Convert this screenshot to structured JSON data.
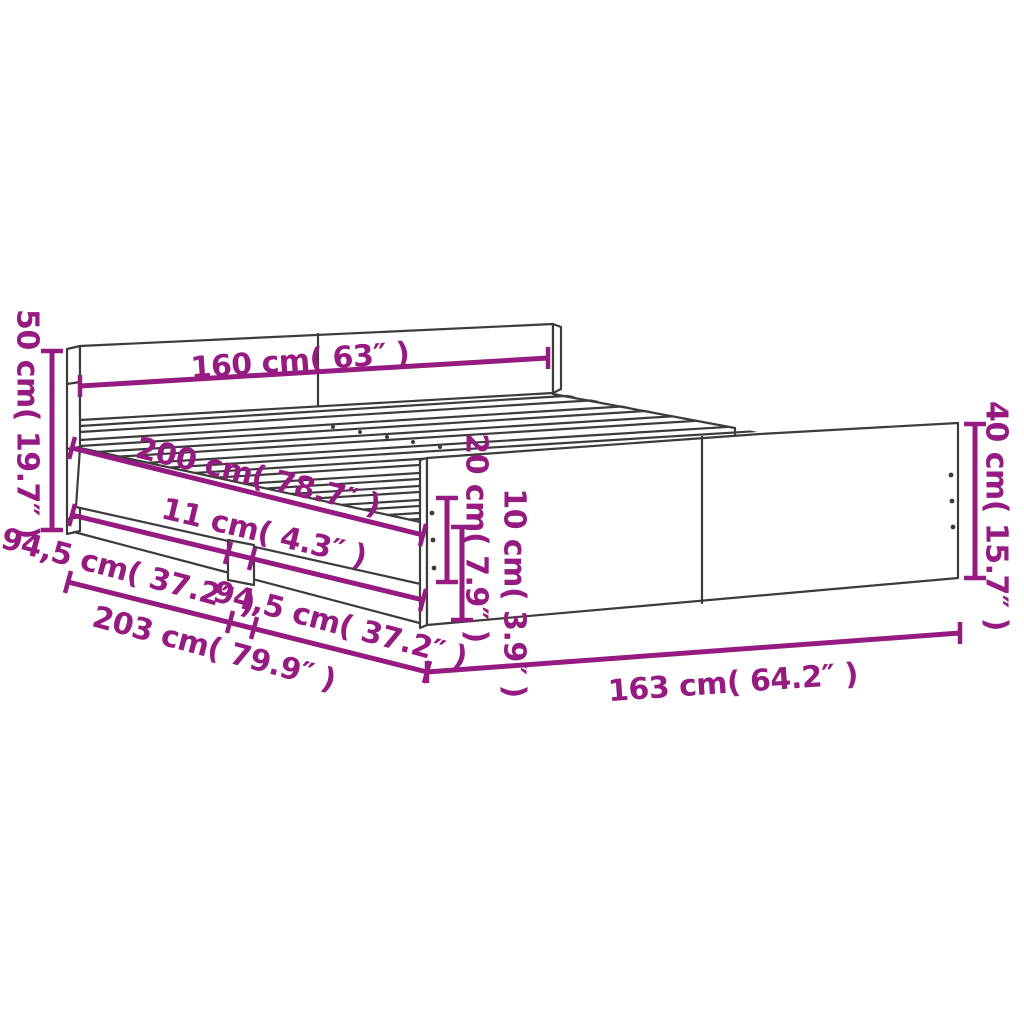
{
  "diagram": {
    "kind": "bed-frame-dimension-diagram",
    "colors": {
      "accent": "#951B81",
      "line": "#3C3C3B",
      "background": "#FFFFFF"
    },
    "labels": {
      "headboard_height": "50 cm( 19.7″ )",
      "bed_width": "160 cm( 63″ )",
      "bed_length": "200 cm( 78.7″ )",
      "center_leg_width": "11 cm( 4.3″ )",
      "rail_section_left": "94,5 cm( 37.2″ )",
      "rail_section_right": "94,5 cm( 37.2″ )",
      "total_length": "203 cm( 79.9″ )",
      "side_rail_height": "20 cm( 7.9″ )",
      "floor_clearance": "10 cm( 3.9″ )",
      "total_width": "163 cm( 64.2″ )",
      "footboard_height": "40 cm( 15.7″ )"
    }
  }
}
